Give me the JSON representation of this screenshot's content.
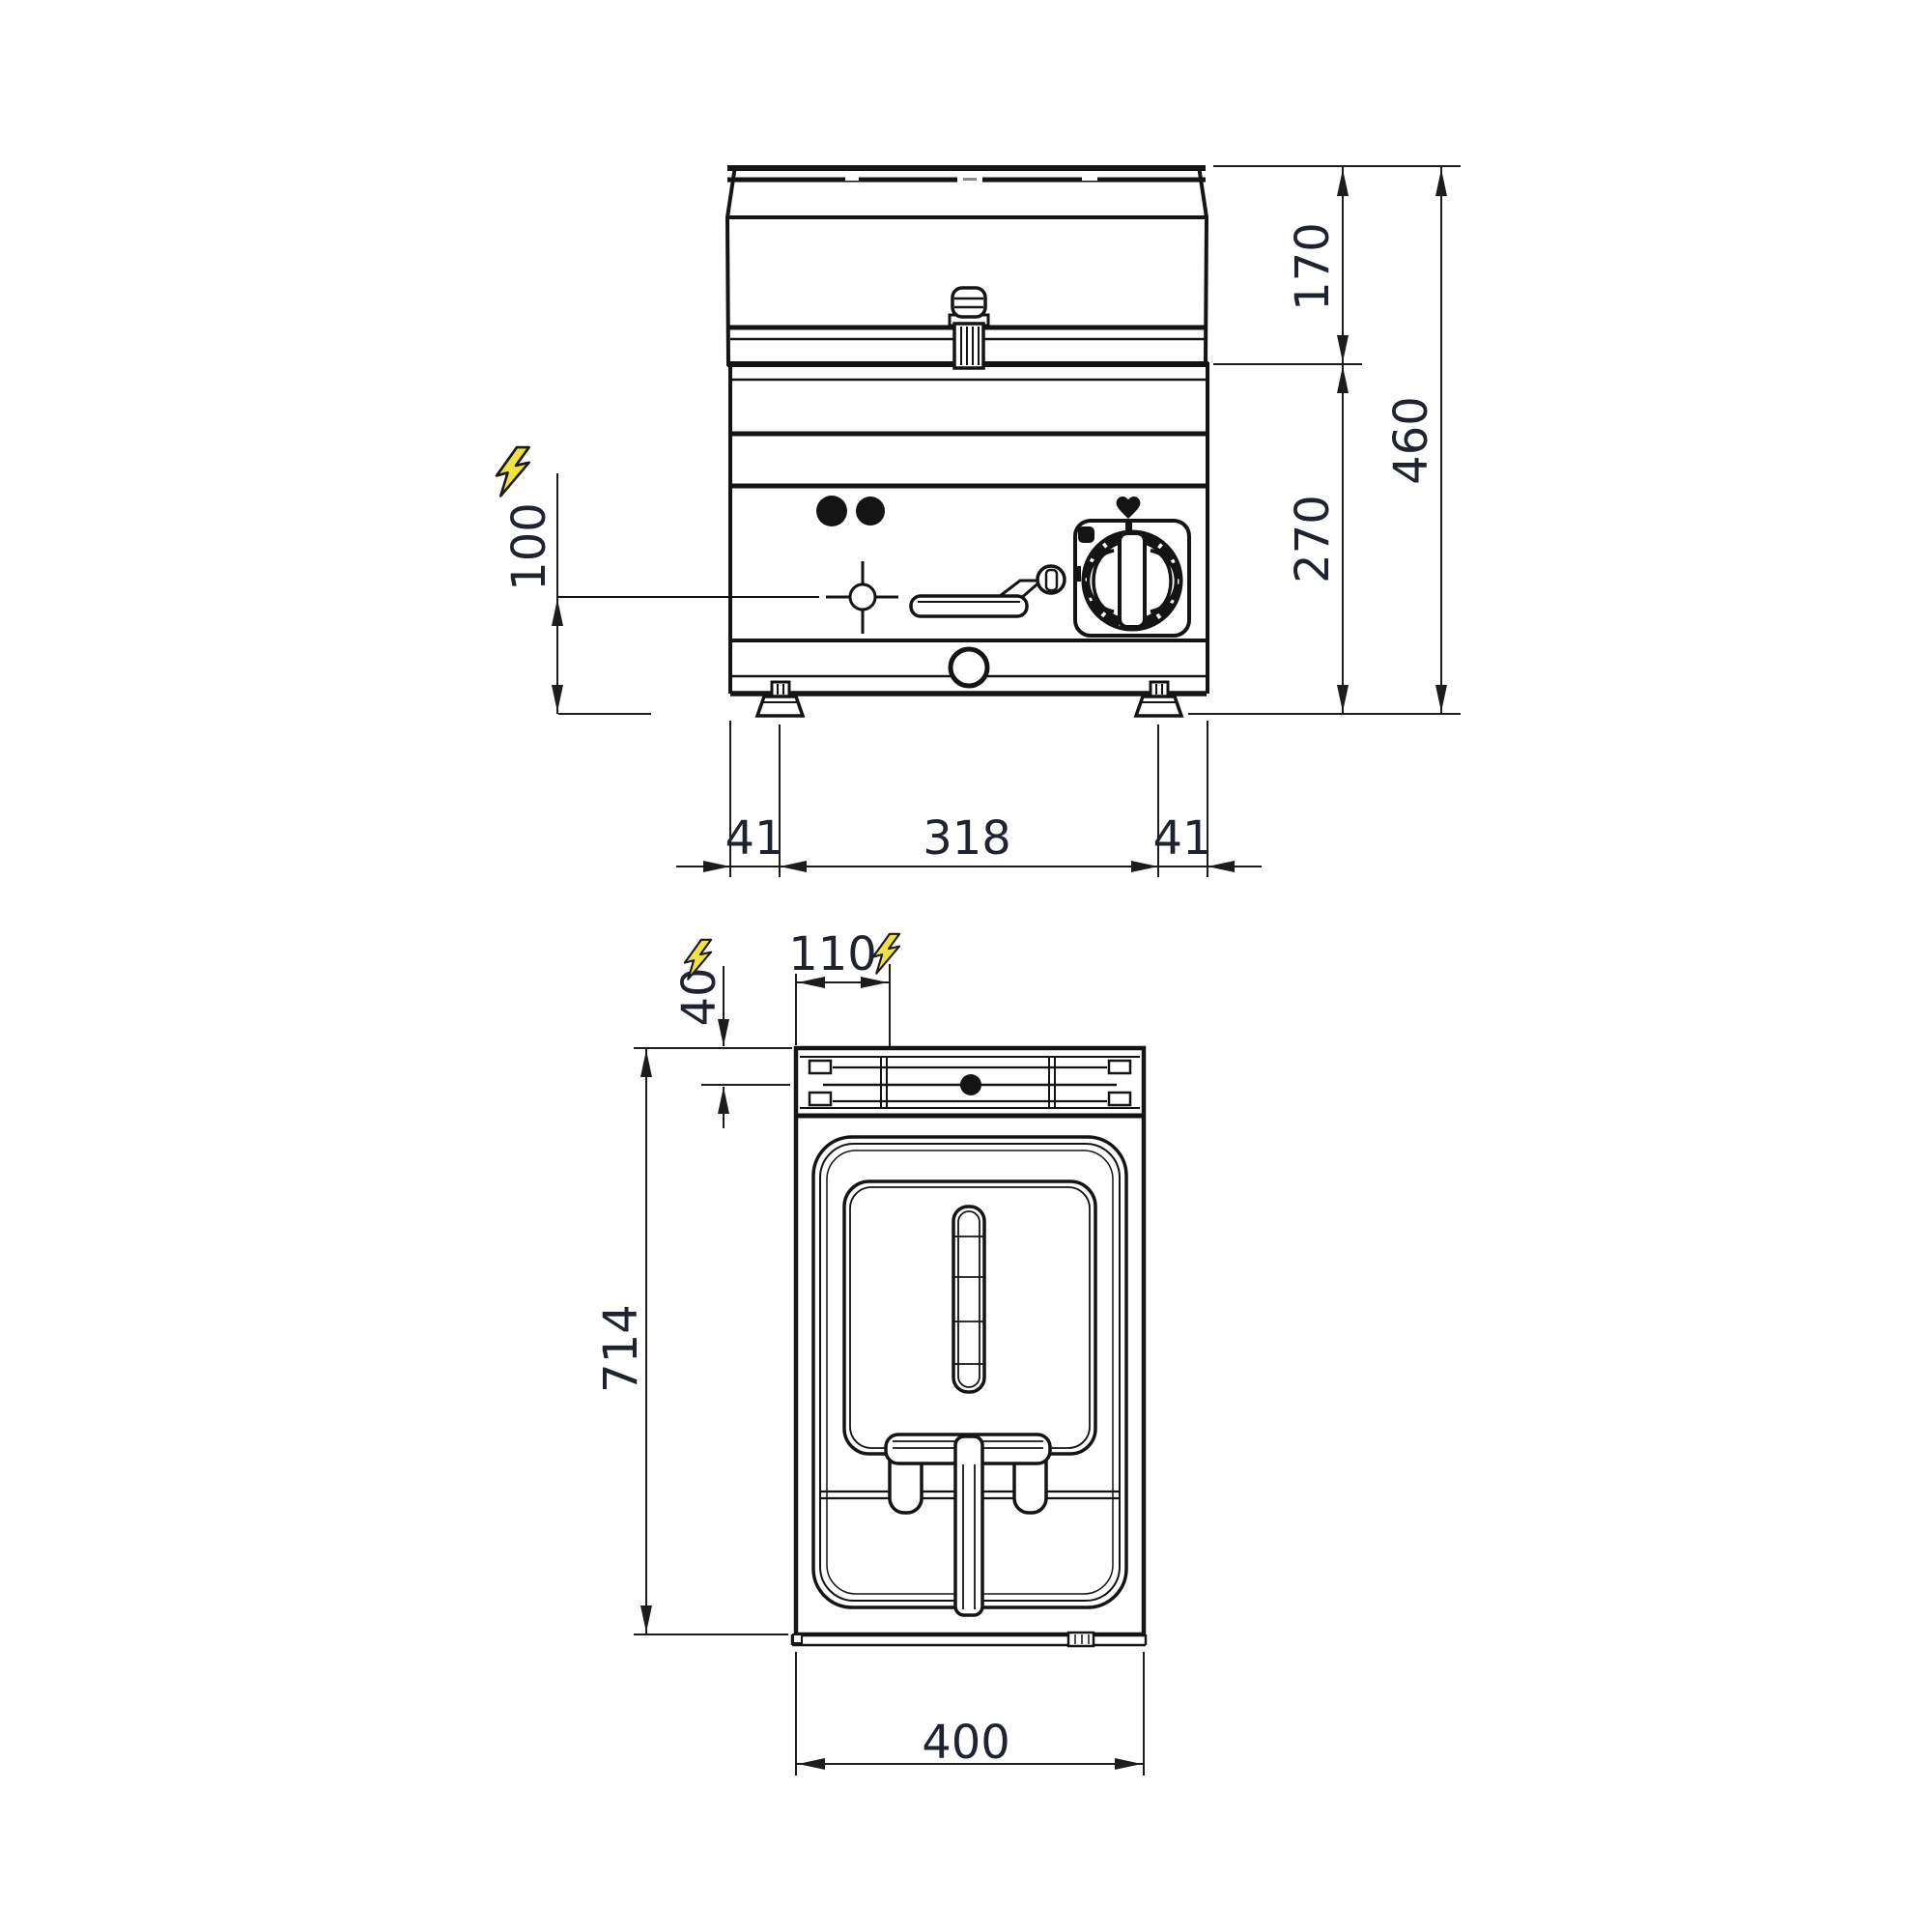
{
  "drawing": {
    "type": "technical-dimension-drawing",
    "subject": "countertop electric fryer, front elevation and plan view",
    "units": "mm",
    "colors": {
      "line": "#141414",
      "dim_text": "#1f2330",
      "electric_symbol_fill": "#f2e33c"
    }
  },
  "front_view": {
    "name": "front-elevation",
    "dims": {
      "lid_height": "170",
      "total_height": "460",
      "body_height": "270",
      "electric_inlet_height": "100",
      "foot_inset_left": "41",
      "foot_spacing": "318",
      "foot_inset_right": "41"
    }
  },
  "plan_view": {
    "name": "top-plan",
    "dims": {
      "back_offset": "40",
      "electric_inlet_x": "110",
      "depth": "714",
      "width": "400"
    }
  },
  "icons": {
    "electric_front": "lightning-bolt",
    "electric_plan_left": "lightning-bolt",
    "electric_plan_right": "lightning-bolt"
  }
}
